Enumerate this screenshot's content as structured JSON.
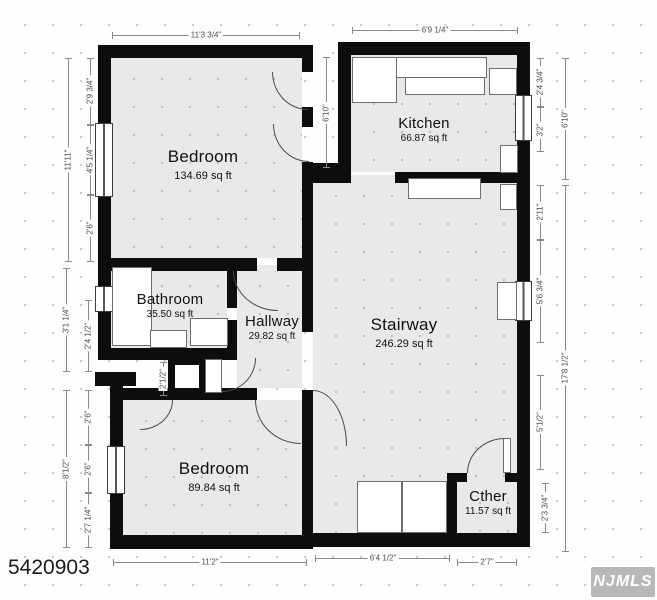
{
  "page": {
    "id_number": "5420903",
    "logo": "NJMLS"
  },
  "rooms": [
    {
      "name": "Bedroom",
      "area": "134.69 sq ft"
    },
    {
      "name": "Kitchen",
      "area": "66.87 sq ft"
    },
    {
      "name": "Bathroom",
      "area": "35.50 sq ft"
    },
    {
      "name": "Hallway",
      "area": "29.82 sq ft"
    },
    {
      "name": "Stairway",
      "area": "246.29 sq ft"
    },
    {
      "name": "Bedroom",
      "area": "89.84 sq ft"
    },
    {
      "name": "Cther",
      "area": "11.57 sq ft"
    }
  ],
  "dimensions": [
    "11'3 3/4\"",
    "6'9 1/4\"",
    "2'9 3/4\"",
    "4'5 1/4\"",
    "2'6\"",
    "11'11\"",
    "3'1 1/4\"",
    "2'4 1/2\"",
    "2'6\"",
    "2'6\"",
    "2'7 1/4\"",
    "8'1/2\"",
    "2'4 3/4\"",
    "3'2\"",
    "6'10\"",
    "2'11\"",
    "5'6 3/4\"",
    "17'8 1/2\"",
    "5'1/2\"",
    "2'3 3/4\"",
    "11'2\"",
    "6'4 1/2\"",
    "2'7\"",
    "6'10\"",
    "2'1/2\""
  ]
}
